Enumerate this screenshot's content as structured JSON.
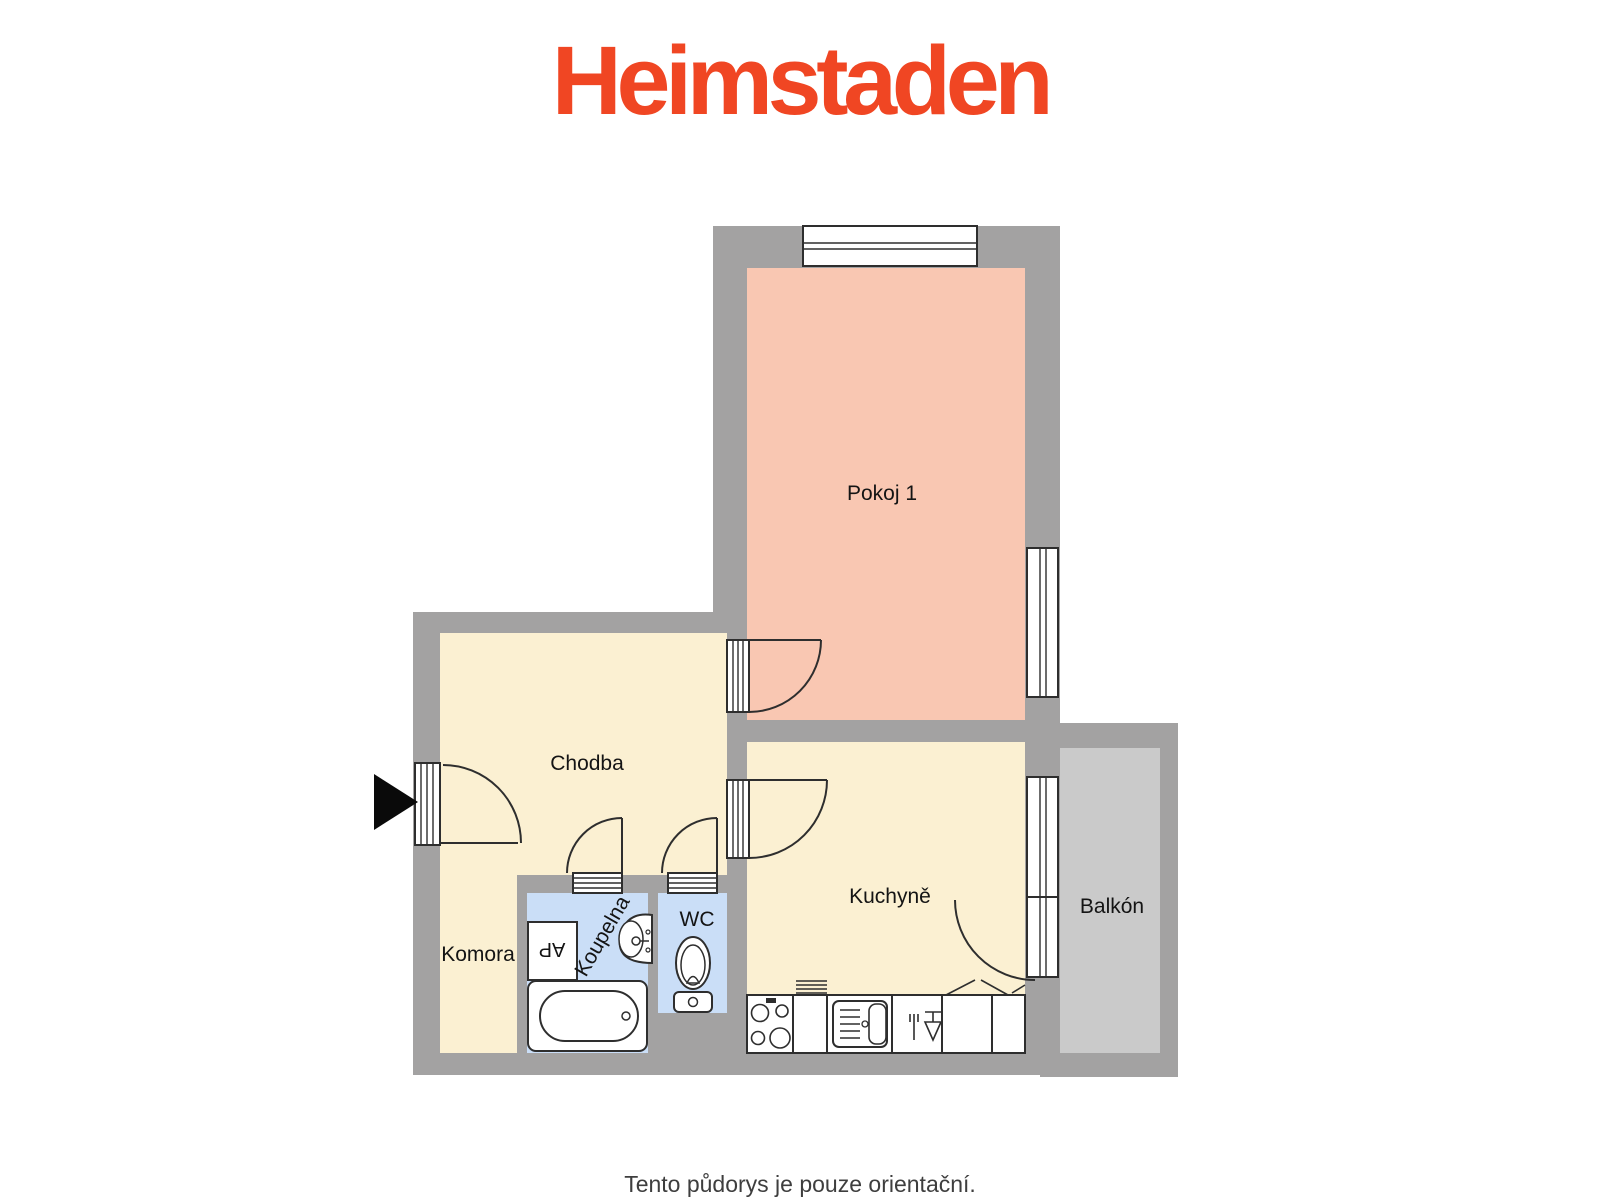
{
  "brand": {
    "logo_text": "Heimstaden",
    "logo_color": "#F04623"
  },
  "floorplan": {
    "wall_color": "#A3A2A2",
    "outline_color": "#2E2E2E",
    "rooms": [
      {
        "id": "pokoj-1",
        "label": "Pokoj 1",
        "fill": "#F9C7B2"
      },
      {
        "id": "chodba",
        "label": "Chodba",
        "fill": "#FBF0D2"
      },
      {
        "id": "komora",
        "label": "Komora",
        "fill": "#FBF0D2"
      },
      {
        "id": "koupelna",
        "label": "Koupelna",
        "fill": "#CADEF7"
      },
      {
        "id": "wc",
        "label": "WC",
        "fill": "#CADEF7"
      },
      {
        "id": "kuchyne",
        "label": "Kuchyně",
        "fill": "#FBF0D2"
      },
      {
        "id": "balkon",
        "label": "Balkón",
        "fill": "#CACACA"
      }
    ],
    "washing_machine_label": "AP"
  },
  "footer": {
    "note": "Tento půdorys je pouze orientační."
  }
}
